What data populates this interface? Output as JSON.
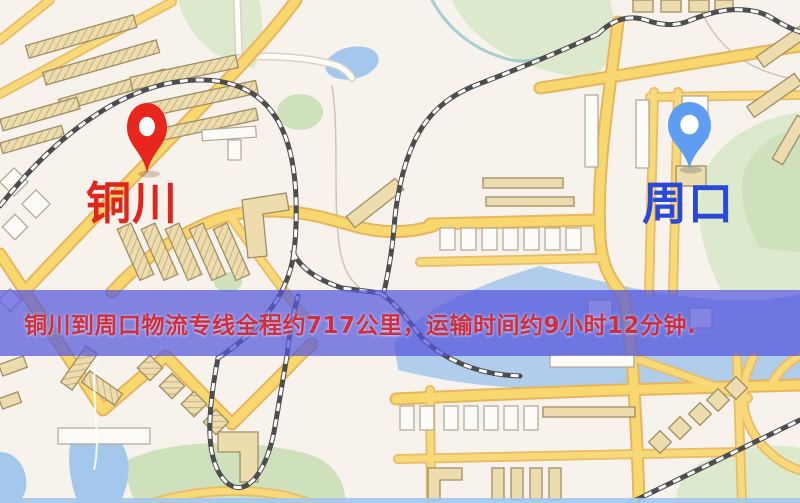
{
  "map": {
    "origin": {
      "label": "铜川",
      "pin_icon": "map-pin-icon",
      "pin_color": "#e8261d",
      "label_color": "#e0251c"
    },
    "destination": {
      "label": "周口",
      "pin_icon": "map-pin-icon",
      "pin_color": "#5f9df3",
      "label_color": "#2b49d8"
    }
  },
  "banner": {
    "text": "铜川到周口物流专线全程约717公里，运输时间约9小时12分钟.",
    "distance_text": "约717公里",
    "duration_text": "约9小时12分钟",
    "text_color": "#cd2f3e",
    "background_color": "rgba(84,86,220,0.72)"
  },
  "map_colors": {
    "background": "#f7f2ec",
    "road_fill": "#f8d76f",
    "road_casing": "#e7b55e",
    "water": "#a3c8ec",
    "park": "#dce9cd",
    "building": "#ecdcae",
    "railway": "#4d4d4d"
  }
}
